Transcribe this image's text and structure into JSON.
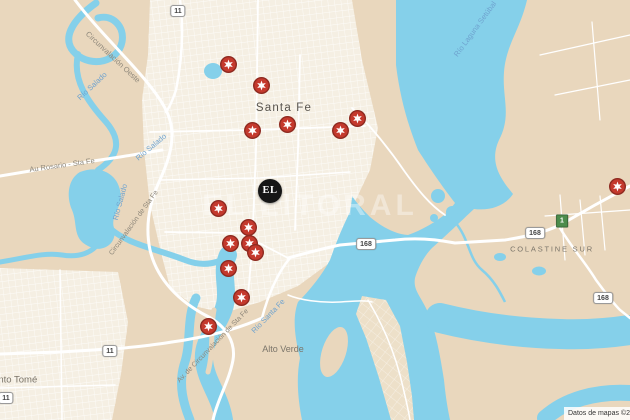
{
  "map": {
    "watermark": "EL LITORAL",
    "attribution": "Datos de mapas ©2019",
    "logo_marker": {
      "label": "EL",
      "x": 270,
      "y": 191
    },
    "colors": {
      "land": "#E9D7BD",
      "urban": "#F5EFE3",
      "water": "#85D0EA",
      "road": "#FFFFFF",
      "marker_red": "#C4392D",
      "marker_ring": "#8E2A20",
      "marker_star": "#FFFFFF",
      "logo_bg": "#161616",
      "shield_green": "#4C8C4C"
    },
    "place_labels": [
      {
        "text": "Santa Fe",
        "x": 284,
        "y": 108,
        "rot": 0,
        "kind": "city"
      },
      {
        "text": "COLASTINE SUR",
        "x": 552,
        "y": 249,
        "rot": 0,
        "kind": "district",
        "size": 7.5,
        "ls": 1.8
      },
      {
        "text": "Alto Verde",
        "x": 283,
        "y": 349,
        "rot": 0,
        "kind": "district",
        "size": 9
      },
      {
        "text": "Santo Tomé",
        "x": 12,
        "y": 380,
        "rot": 0,
        "kind": "district",
        "size": 9.5
      },
      {
        "text": "Circunvalación Oeste",
        "x": 113,
        "y": 57,
        "rot": 43,
        "kind": "road"
      },
      {
        "text": "Au Rosario - Sta Fe",
        "x": 62,
        "y": 165,
        "rot": -8,
        "kind": "road"
      },
      {
        "text": "Circunvalación de Sta Fe",
        "x": 134,
        "y": 223,
        "rot": -54,
        "kind": "road",
        "size": 7
      },
      {
        "text": "Av. de Circunvalación de Sta Fe",
        "x": 213,
        "y": 346,
        "rot": -46,
        "kind": "road",
        "size": 7
      },
      {
        "text": "Río Salado",
        "x": 92,
        "y": 86,
        "rot": -43,
        "kind": "water"
      },
      {
        "text": "Río Salado",
        "x": 120,
        "y": 202,
        "rot": -75,
        "kind": "water"
      },
      {
        "text": "Río Salado",
        "x": 151,
        "y": 147,
        "rot": -40,
        "kind": "water"
      },
      {
        "text": "Río Santa Fe",
        "x": 268,
        "y": 316,
        "rot": -46,
        "kind": "water"
      },
      {
        "text": "Río Laguna Setúbal",
        "x": 475,
        "y": 29,
        "rot": -54,
        "kind": "water"
      }
    ],
    "road_shields": [
      {
        "label": "11",
        "x": 178,
        "y": 11,
        "kind": "national"
      },
      {
        "label": "11",
        "x": 110,
        "y": 351,
        "kind": "national"
      },
      {
        "label": "11",
        "x": 6,
        "y": 398,
        "kind": "national"
      },
      {
        "label": "168",
        "x": 366,
        "y": 244,
        "kind": "national"
      },
      {
        "label": "168",
        "x": 535,
        "y": 233,
        "kind": "national"
      },
      {
        "label": "168",
        "x": 603,
        "y": 298,
        "kind": "national"
      },
      {
        "label": "1",
        "x": 562,
        "y": 221,
        "kind": "provincial"
      }
    ],
    "markers": [
      {
        "x": 228,
        "y": 64
      },
      {
        "x": 261,
        "y": 85
      },
      {
        "x": 252,
        "y": 130
      },
      {
        "x": 287,
        "y": 124
      },
      {
        "x": 340,
        "y": 130
      },
      {
        "x": 357,
        "y": 118
      },
      {
        "x": 218,
        "y": 208
      },
      {
        "x": 248,
        "y": 227
      },
      {
        "x": 230,
        "y": 243
      },
      {
        "x": 249,
        "y": 243
      },
      {
        "x": 255,
        "y": 252
      },
      {
        "x": 228,
        "y": 268
      },
      {
        "x": 241,
        "y": 297
      },
      {
        "x": 208,
        "y": 326
      },
      {
        "x": 617,
        "y": 186
      }
    ]
  }
}
